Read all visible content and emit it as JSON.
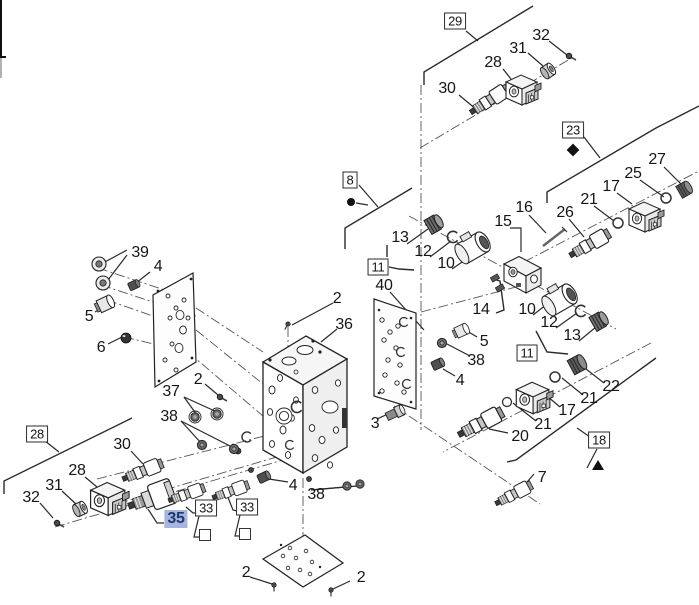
{
  "diagram": {
    "kind": "exploded-parts-diagram",
    "line_color": "#222222",
    "axis_color": "#555555",
    "highlight_bg": "#a7b4dd",
    "highlight_fg": "#1d3a6f",
    "callouts": [
      {
        "t": "29",
        "x": 455,
        "y": 21,
        "s": "boxed"
      },
      {
        "t": "32",
        "x": 541,
        "y": 36,
        "s": "plain"
      },
      {
        "t": "31",
        "x": 518,
        "y": 49,
        "s": "plain"
      },
      {
        "t": "28",
        "x": 493,
        "y": 63,
        "s": "plain"
      },
      {
        "t": "30",
        "x": 447,
        "y": 89,
        "s": "plain"
      },
      {
        "t": "23",
        "x": 573,
        "y": 130,
        "s": "boxed"
      },
      {
        "t": "27",
        "x": 657,
        "y": 160,
        "s": "plain"
      },
      {
        "t": "25",
        "x": 633,
        "y": 174,
        "s": "plain"
      },
      {
        "t": "17",
        "x": 611,
        "y": 187,
        "s": "plain"
      },
      {
        "t": "21",
        "x": 589,
        "y": 200,
        "s": "plain"
      },
      {
        "t": "26",
        "x": 565,
        "y": 213,
        "s": "plain"
      },
      {
        "t": "16",
        "x": 524,
        "y": 208,
        "s": "plain"
      },
      {
        "t": "15",
        "x": 503,
        "y": 222,
        "s": "plain"
      },
      {
        "t": "8",
        "x": 350,
        "y": 180,
        "s": "boxed"
      },
      {
        "t": "13",
        "x": 400,
        "y": 238,
        "s": "plain"
      },
      {
        "t": "12",
        "x": 423,
        "y": 252,
        "s": "plain"
      },
      {
        "t": "10",
        "x": 446,
        "y": 264,
        "s": "plain"
      },
      {
        "t": "11",
        "x": 378,
        "y": 267,
        "s": "boxed"
      },
      {
        "t": "40",
        "x": 384,
        "y": 286,
        "s": "plain"
      },
      {
        "t": "2",
        "x": 337,
        "y": 299,
        "s": "plain"
      },
      {
        "t": "36",
        "x": 344,
        "y": 325,
        "s": "plain"
      },
      {
        "t": "14",
        "x": 481,
        "y": 310,
        "s": "plain"
      },
      {
        "t": "10",
        "x": 527,
        "y": 310,
        "s": "plain"
      },
      {
        "t": "12",
        "x": 549,
        "y": 323,
        "s": "plain"
      },
      {
        "t": "13",
        "x": 572,
        "y": 336,
        "s": "plain"
      },
      {
        "t": "11",
        "x": 527,
        "y": 353,
        "s": "boxed"
      },
      {
        "t": "5",
        "x": 484,
        "y": 342,
        "s": "plain"
      },
      {
        "t": "38",
        "x": 476,
        "y": 361,
        "s": "plain"
      },
      {
        "t": "4",
        "x": 460,
        "y": 381,
        "s": "plain"
      },
      {
        "t": "22",
        "x": 611,
        "y": 387,
        "s": "plain"
      },
      {
        "t": "21",
        "x": 589,
        "y": 399,
        "s": "plain"
      },
      {
        "t": "17",
        "x": 567,
        "y": 411,
        "s": "plain"
      },
      {
        "t": "21",
        "x": 543,
        "y": 425,
        "s": "plain"
      },
      {
        "t": "20",
        "x": 520,
        "y": 437,
        "s": "plain"
      },
      {
        "t": "18",
        "x": 599,
        "y": 440,
        "s": "boxed"
      },
      {
        "t": "7",
        "x": 542,
        "y": 478,
        "s": "plain"
      },
      {
        "t": "39",
        "x": 140,
        "y": 253,
        "s": "plain"
      },
      {
        "t": "4",
        "x": 158,
        "y": 267,
        "s": "plain"
      },
      {
        "t": "5",
        "x": 89,
        "y": 317,
        "s": "plain"
      },
      {
        "t": "6",
        "x": 101,
        "y": 348,
        "s": "plain"
      },
      {
        "t": "2",
        "x": 198,
        "y": 380,
        "s": "plain"
      },
      {
        "t": "37",
        "x": 171,
        "y": 392,
        "s": "plain"
      },
      {
        "t": "38",
        "x": 169,
        "y": 417,
        "s": "plain"
      },
      {
        "t": "28",
        "x": 37,
        "y": 434,
        "s": "boxed"
      },
      {
        "t": "30",
        "x": 122,
        "y": 445,
        "s": "plain"
      },
      {
        "t": "28",
        "x": 77,
        "y": 471,
        "s": "plain"
      },
      {
        "t": "31",
        "x": 54,
        "y": 486,
        "s": "plain"
      },
      {
        "t": "32",
        "x": 31,
        "y": 498,
        "s": "plain"
      },
      {
        "t": "35",
        "x": 176,
        "y": 519,
        "s": "highlighted"
      },
      {
        "t": "33",
        "x": 206,
        "y": 508,
        "s": "boxed"
      },
      {
        "t": "33",
        "x": 247,
        "y": 507,
        "s": "boxed"
      },
      {
        "t": "3",
        "x": 375,
        "y": 424,
        "s": "plain"
      },
      {
        "t": "4",
        "x": 293,
        "y": 486,
        "s": "plain"
      },
      {
        "t": "38",
        "x": 316,
        "y": 495,
        "s": "plain"
      },
      {
        "t": "2",
        "x": 246,
        "y": 573,
        "s": "plain"
      },
      {
        "t": "2",
        "x": 361,
        "y": 578,
        "s": "plain"
      }
    ],
    "markers": [
      {
        "type": "diamond",
        "x": 573,
        "y": 150
      },
      {
        "type": "dot",
        "x": 351,
        "y": 202
      },
      {
        "type": "triangle",
        "x": 598,
        "y": 465
      },
      {
        "type": "square",
        "x": 205,
        "y": 535
      },
      {
        "type": "square",
        "x": 245,
        "y": 534
      }
    ]
  }
}
